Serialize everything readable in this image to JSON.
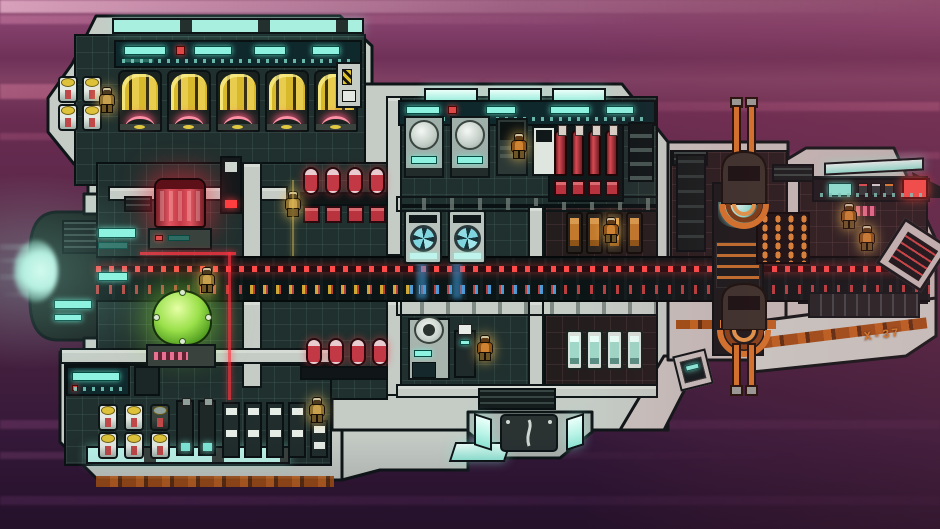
{
  "scene": {
    "type": "game-screenshot",
    "subject": "pixel-art starship interior cross-section flying through warp space",
    "background": "purple and magenta motion streaks"
  },
  "ship": {
    "hull_label": "X-37"
  },
  "palette": {
    "space-top": "#8d4e71",
    "space-bottom": "#2a1430",
    "hull": "#c5ccc6",
    "hull-warm": "#c8c2be",
    "outline": "#0d1517",
    "room": "#20302e",
    "room-warm": "#241d1e",
    "corridor": "#0c1516",
    "screen-cyan": "#8df2e0",
    "window-cyan": "#bdf7ec",
    "engine-yellow": "#d9b92c",
    "engine-arc-pink": "#ff8fa5",
    "reactor-red": "#d84a52",
    "beam-red": "#ff3340",
    "dome-green": "#9ae04a",
    "crew-tan": "#c9a14e",
    "crew-orange": "#d08432",
    "turret-orange": "#d9772b",
    "stripe-rust": "#c2651f",
    "glow-blue": "#4fb8ff",
    "tick-yellow": "#e0b838"
  },
  "rooms": [
    {
      "id": "engine-room",
      "machines": [
        "thruster-engine x5",
        "fuel-canister x4",
        "overhead-console",
        "striped-hatch"
      ]
    },
    {
      "id": "reactor-bay",
      "machines": [
        "red-reactor",
        "tall-locker",
        "wall-screens"
      ]
    },
    {
      "id": "capacitor-bay",
      "machines": [
        "red-capacitor-rack x2 (4 cells each)"
      ]
    },
    {
      "id": "life-support",
      "machines": [
        "green-biodome"
      ]
    },
    {
      "id": "central-corridor",
      "machines": [
        "red-light-rail",
        "colored-deck-ticks"
      ]
    },
    {
      "id": "fabrication-room",
      "machines": [
        "round-top-machine x2",
        "dark-cabinet",
        "small-unit",
        "red-cylinder-bank x4",
        "shelf"
      ]
    },
    {
      "id": "laundry-room",
      "machines": [
        "fan-washer x2"
      ]
    },
    {
      "id": "seating-upper",
      "machines": [
        "orange-seat x4"
      ]
    },
    {
      "id": "utility-room",
      "machines": [
        "round-boiler",
        "service-bot"
      ]
    },
    {
      "id": "seating-lower",
      "machines": [
        "teal-seat x4"
      ]
    },
    {
      "id": "cargo-hold",
      "machines": [
        "fuel-canister x6",
        "glow-tank x2",
        "locker x5",
        "corner-console"
      ]
    },
    {
      "id": "gun-deck",
      "machines": [
        "turret-top",
        "turret-bottom",
        "ammo-rack",
        "mount-glow-console"
      ]
    },
    {
      "id": "cockpit",
      "machines": [
        "console-strip",
        "red-alert-screen",
        "angled-nav-console"
      ]
    }
  ],
  "crew": {
    "count": 9,
    "suit_colors": [
      "tan-yellow",
      "orange"
    ]
  }
}
